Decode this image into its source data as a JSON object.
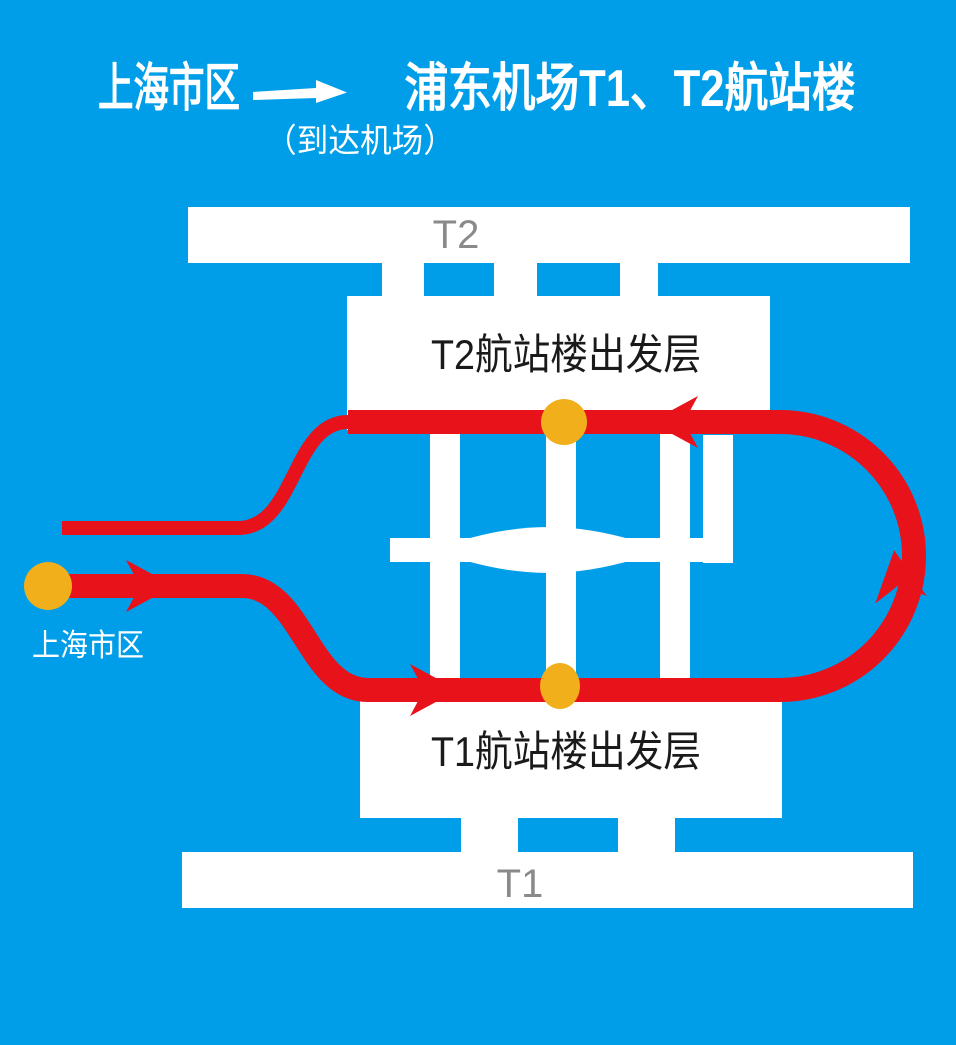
{
  "colors": {
    "background": "#009EE8",
    "road_white": "#FFFFFF",
    "route_red": "#E8121A",
    "stop_yellow": "#F2AF1C",
    "terminal_gray": "#8A8A8A",
    "label_black": "#1A1A1A",
    "title_white": "#FFFFFF"
  },
  "header": {
    "origin": "上海市区",
    "arrow_icon": "right-arrow",
    "destination": "浦东机场T1、T2航站楼",
    "subtitle": "（到达机场）"
  },
  "diagram": {
    "t2_building_label": "T2",
    "t1_building_label": "T1",
    "t2_departure_label": "T2航站楼出发层",
    "t1_departure_label": "T1航站楼出发层",
    "city_label": "上海市区",
    "stops": [
      {
        "name": "上海市区出发点"
      },
      {
        "name": "T1航站楼出发层停靠点"
      },
      {
        "name": "T2航站楼出发层停靠点"
      }
    ],
    "route_direction": "市区→T1出发层→T2出发层→返回市区"
  }
}
